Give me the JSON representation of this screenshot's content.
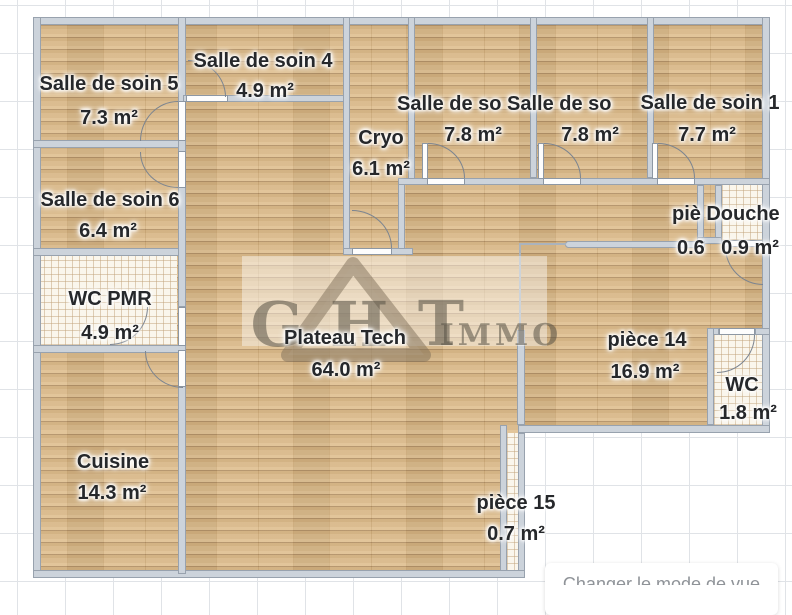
{
  "watermark": {
    "letter_g": "G",
    "letter_h": "H",
    "letter_t": "T",
    "suffix": "IMMO"
  },
  "rooms": {
    "salle5": {
      "name": "Salle de soin 5",
      "area": "7.3 m²"
    },
    "salle4": {
      "name": "Salle de soin 4",
      "area": "4.9 m²"
    },
    "salle6": {
      "name": "Salle de soin 6",
      "area": "6.4 m²"
    },
    "wc_pmr": {
      "name": "WC PMR",
      "area": "4.9 m²"
    },
    "cuisine": {
      "name": "Cuisine",
      "area": "14.3 m²"
    },
    "cryo": {
      "name": "Cryo",
      "area": "6.1 m²"
    },
    "plateau_tech": {
      "name": "Plateau Tech",
      "area": "64.0 m²"
    },
    "salle3": {
      "name": "Salle de so",
      "area": "7.8 m²"
    },
    "salle2": {
      "name": "Salle de so",
      "area": "7.8 m²"
    },
    "salle1": {
      "name": "Salle de soin 1",
      "area": "7.7 m²"
    },
    "piece_small": {
      "name": "piè",
      "area": "0.6"
    },
    "douche": {
      "name": "Douche",
      "area": "0.9 m²"
    },
    "piece14": {
      "name": "pièce 14",
      "area": "16.9 m²"
    },
    "wc": {
      "name": "WC",
      "area": "1.8 m²"
    },
    "piece15": {
      "name": "pièce 15",
      "area": "0.7 m²"
    }
  },
  "controls": {
    "change_view_label": "Changer le mode de vue"
  },
  "colors": {
    "wall": "#ccd3db",
    "wood_floor": "#d8b88a",
    "tile_floor": "#faf6ec",
    "grid_line": "#e0e3e7",
    "label_text": "#26282b",
    "button_text": "#8f9398"
  }
}
